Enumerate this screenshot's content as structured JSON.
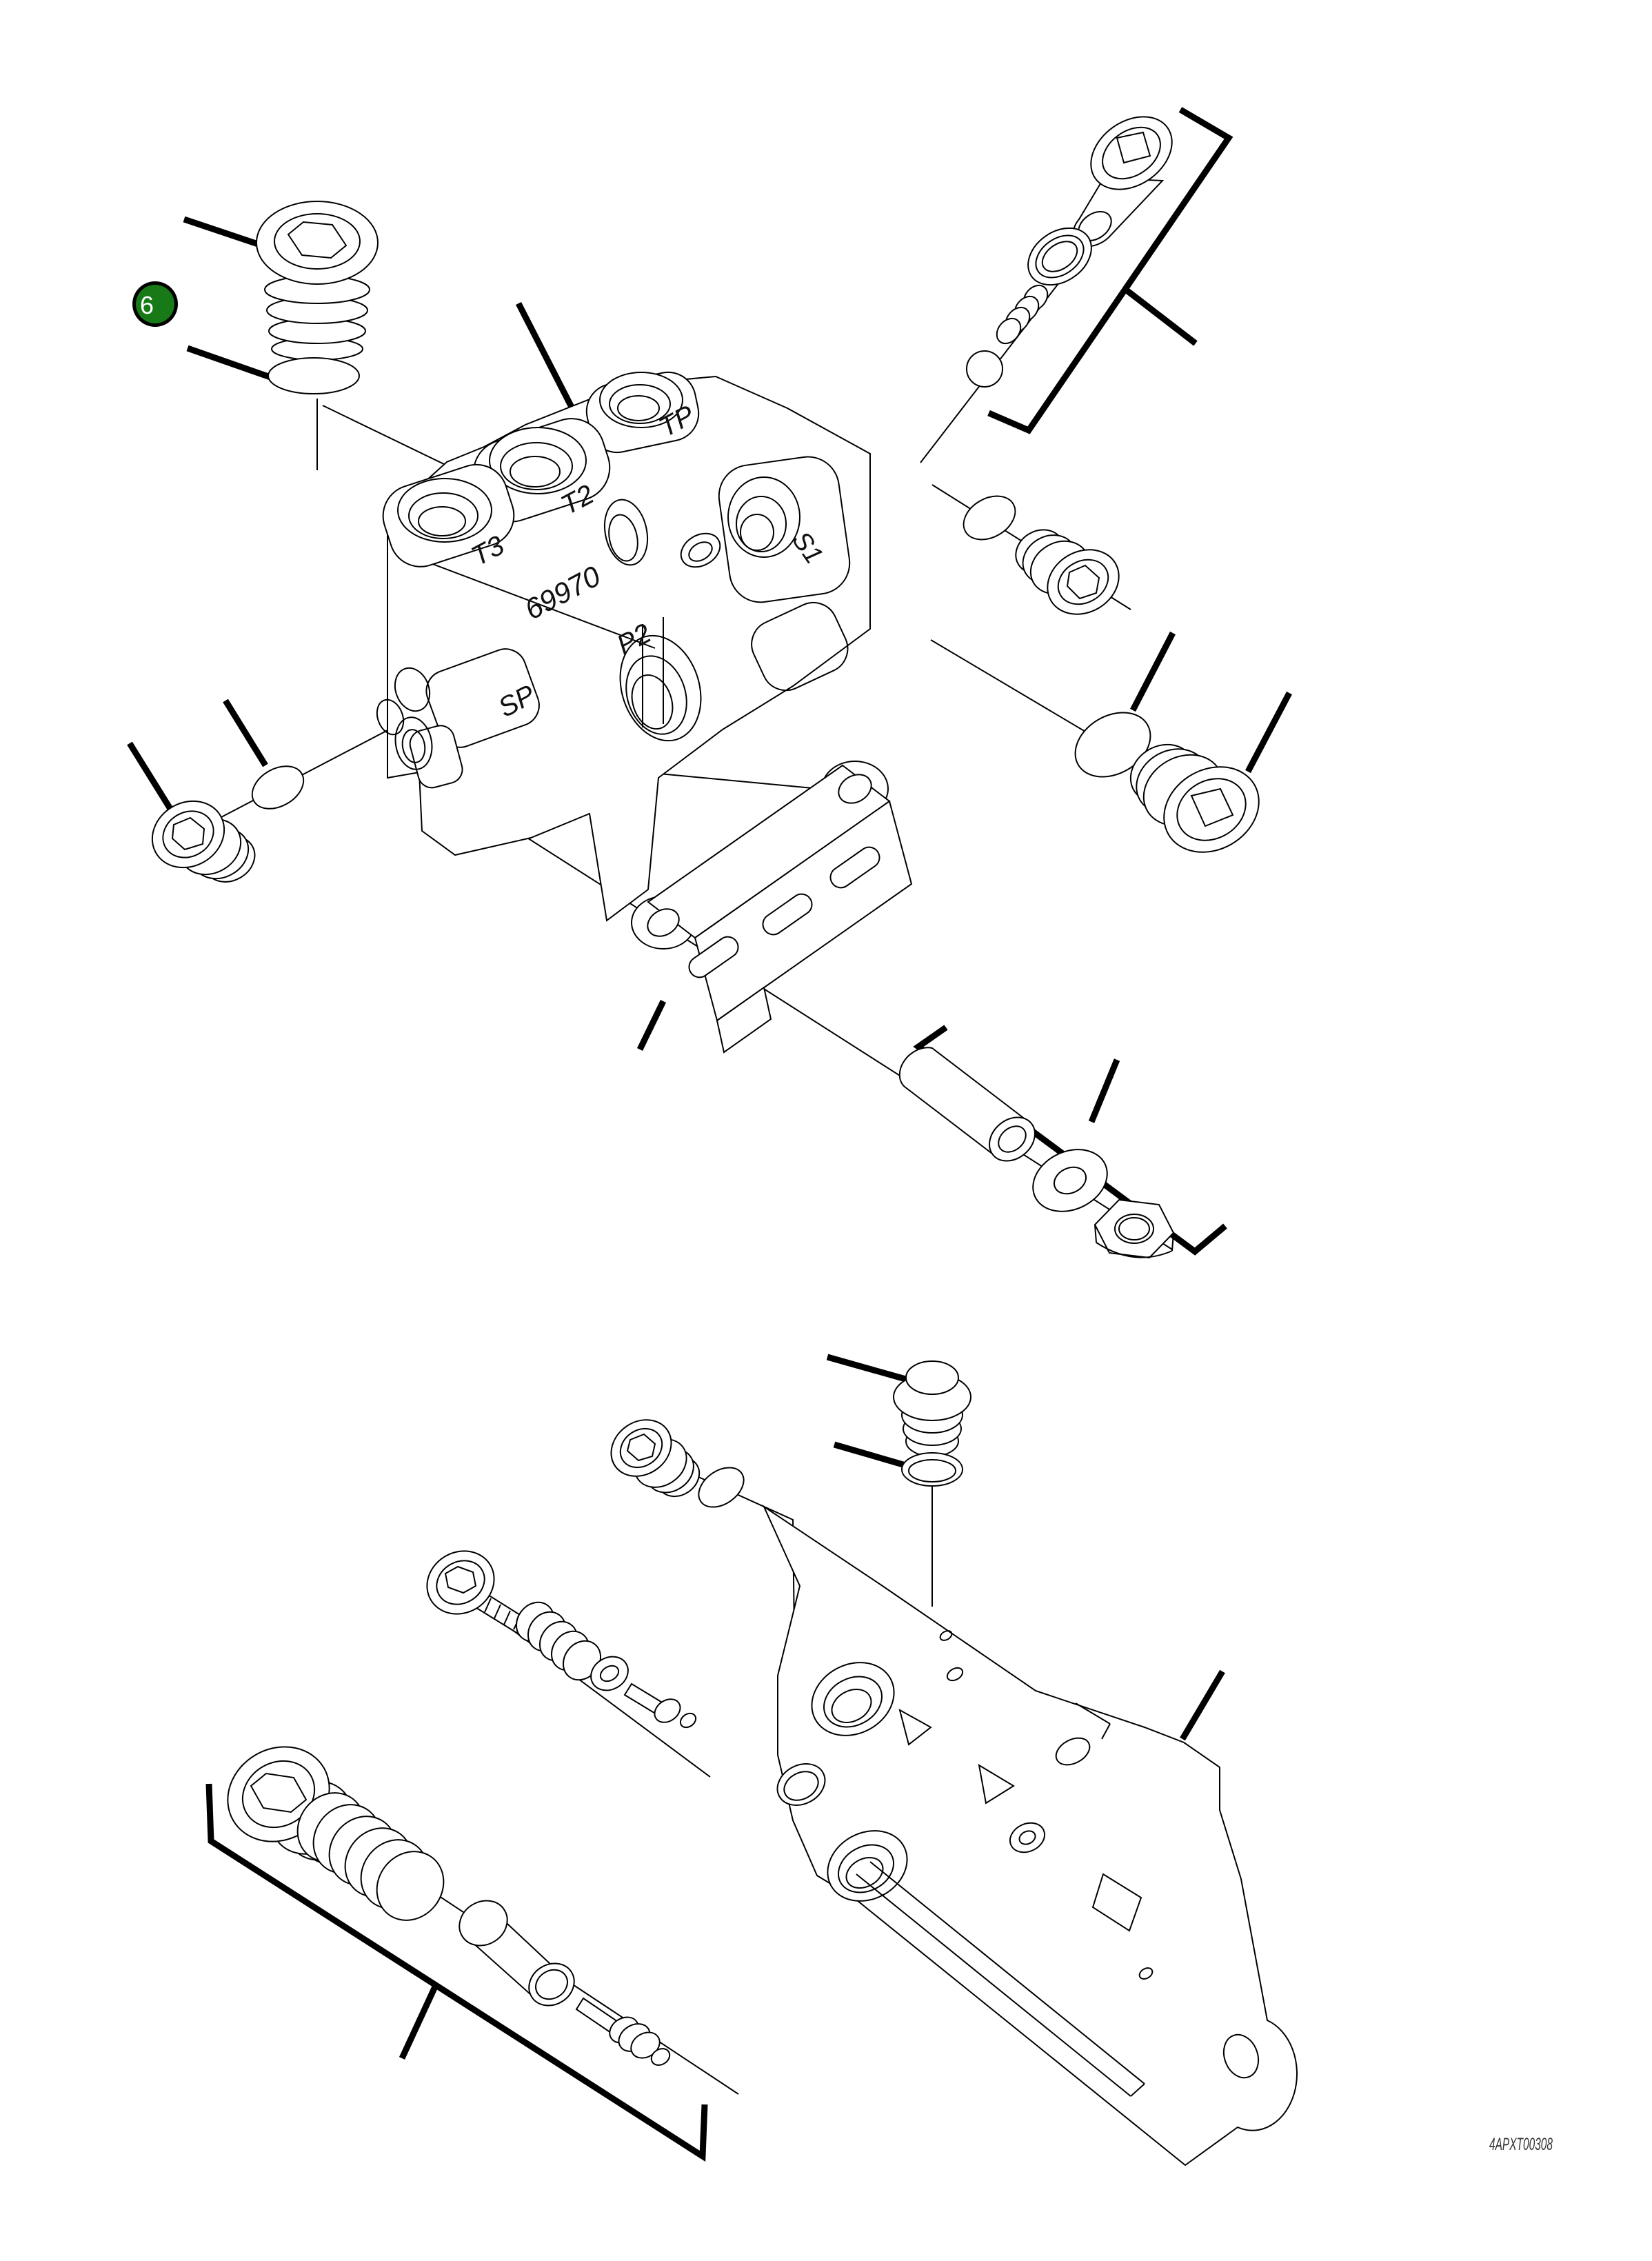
{
  "page": {
    "background": "#ffffff"
  },
  "callout": {
    "number": "6",
    "fill": "#177a17",
    "ring": "#000000",
    "text_color": "#ffffff"
  },
  "block": {
    "casting_number": "69970",
    "ports": [
      {
        "label": "T3"
      },
      {
        "label": "T2"
      },
      {
        "label": "TP"
      },
      {
        "label": "SP"
      },
      {
        "label": "P2"
      },
      {
        "label": "S1"
      }
    ]
  },
  "footer": {
    "drawing_code": "4APXT00308"
  },
  "line_colors": {
    "outline": "#000000",
    "leader": "#000000"
  }
}
